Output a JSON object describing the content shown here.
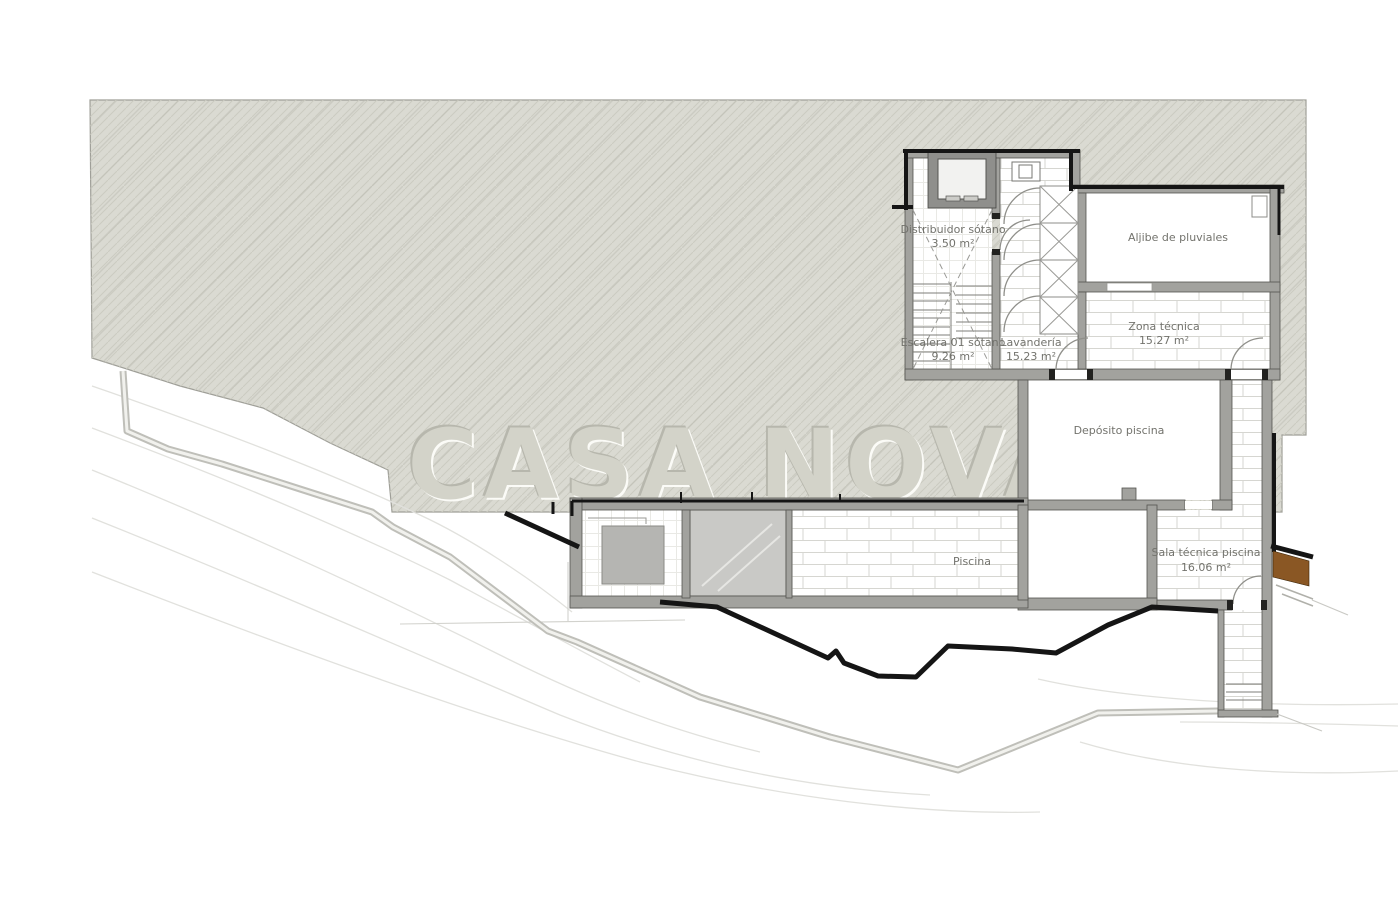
{
  "watermark": {
    "text": "CASA NOVA"
  },
  "rooms": {
    "distribuidor": {
      "name": "Distribuidor sótano",
      "area": "3.50 m²"
    },
    "aljibe": {
      "name": "Aljibe de pluviales"
    },
    "escalera": {
      "name": "Escalera 01 sótano",
      "area": "9.26 m²"
    },
    "lavanderia": {
      "name": "Lavandería",
      "area": "15.23 m²"
    },
    "zona_tecnica": {
      "name": "Zona técnica",
      "area": "15.27 m²"
    },
    "deposito": {
      "name": "Depósito piscina"
    },
    "piscina": {
      "name": "Piscina"
    },
    "sala_tecnica": {
      "name": "Sala técnica piscina",
      "area": "16.06 m²"
    }
  },
  "colors": {
    "terrain_fill": "#dadad2",
    "terrain_hatch": "#cbcbc1",
    "wall_gray": "#a2a29e",
    "outline_black": "#151515",
    "wood_brown": "#8a5724",
    "label_text": "#73736d",
    "glass_gray": "#c9c9c6"
  }
}
